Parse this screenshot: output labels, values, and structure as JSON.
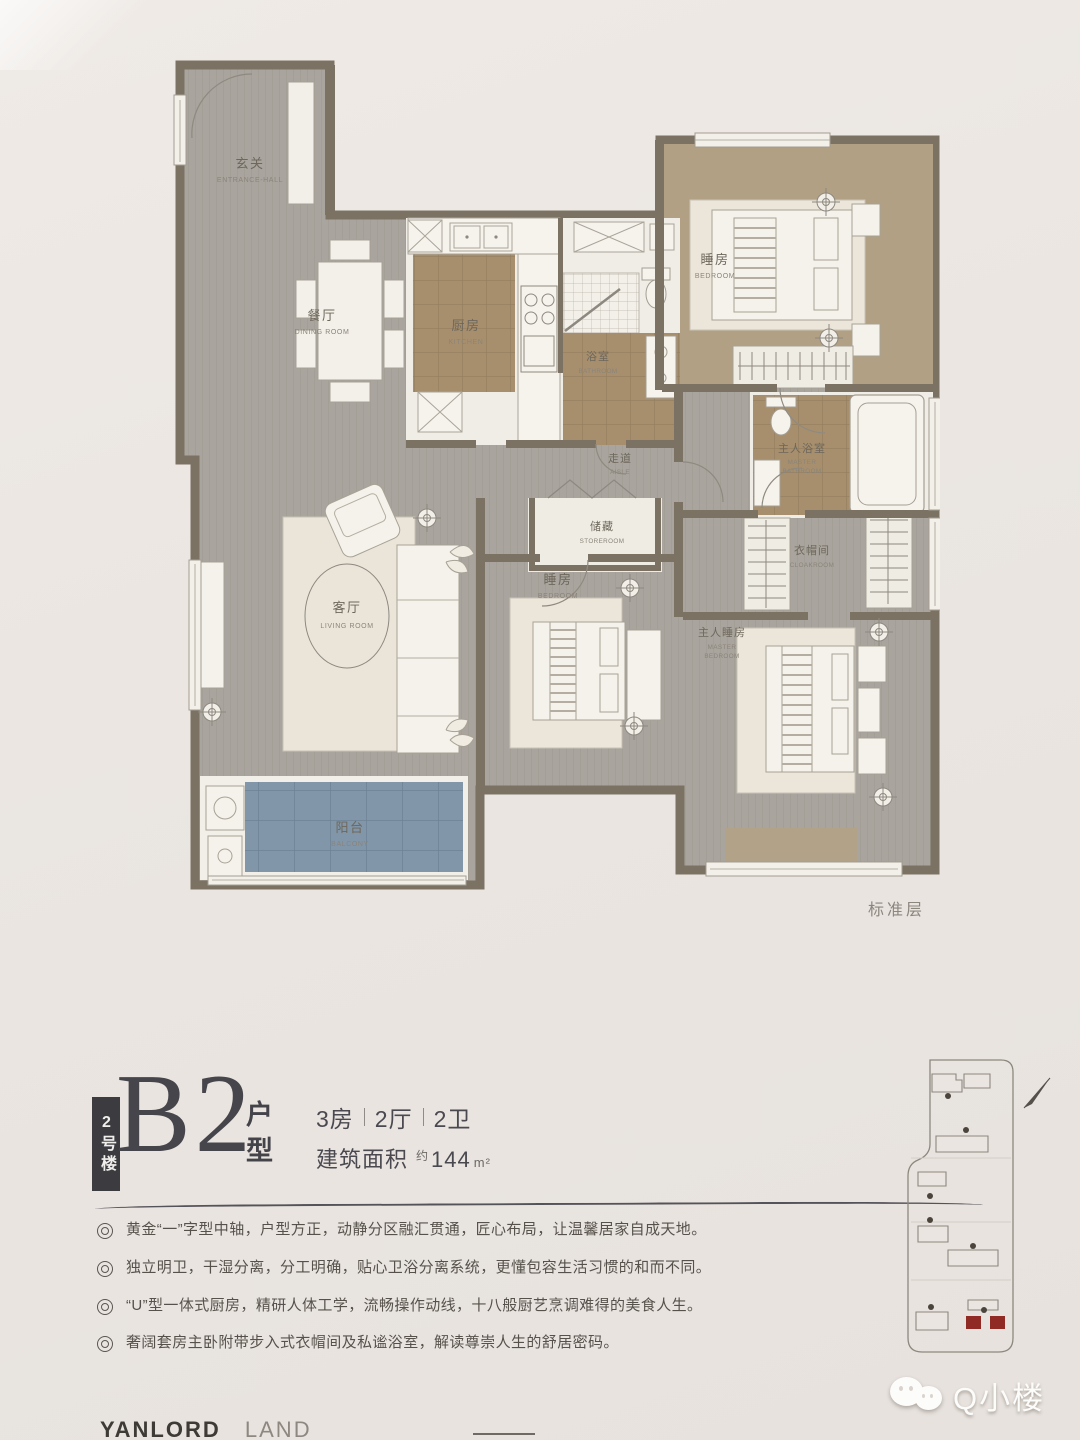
{
  "plan": {
    "floor_note": "标准层",
    "rooms": {
      "entrance": {
        "zh": "玄关",
        "en": "ENTRANCE-HALL"
      },
      "dining": {
        "zh": "餐厅",
        "en": "DINING ROOM"
      },
      "kitchen": {
        "zh": "厨房",
        "en": "KITCHEN"
      },
      "bathroom": {
        "zh": "浴室",
        "en": "BATHROOM"
      },
      "bedroom_top": {
        "zh": "睡房",
        "en": "BEDROOM"
      },
      "master_bathroom": {
        "zh": "主人浴室",
        "en1": "MASTER",
        "en2": "BATHROOM"
      },
      "aisle": {
        "zh": "走道",
        "en": "AISLE"
      },
      "storeroom": {
        "zh": "储藏",
        "en": "STOREROOM"
      },
      "bedroom_mid": {
        "zh": "睡房",
        "en": "BEDROOM"
      },
      "cloakroom": {
        "zh": "衣帽间",
        "en": "CLOAKROOM"
      },
      "living": {
        "zh": "客厅",
        "en": "LIVING ROOM"
      },
      "master_bedroom": {
        "zh": "主人睡房",
        "en1": "MASTER",
        "en2": "BEDROOM"
      },
      "balcony": {
        "zh": "阳台",
        "en": "BALCONY"
      }
    }
  },
  "title": {
    "building_badge": "2号楼",
    "code": "B2",
    "suffix_line1": "户",
    "suffix_line2": "型",
    "spec_parts": [
      "3房",
      "2厅",
      "2卫"
    ],
    "area_label": "建筑面积",
    "area_approx": "约",
    "area_value": "144",
    "area_unit": "m²"
  },
  "features": [
    "黄金“一”字型中轴，户型方正，动静分区融汇贯通，匠心布局，让温馨居家自成天地。",
    "独立明卫，干湿分离，分工明确，贴心卫浴分离系统，更懂包容生活习惯的和而不同。",
    "“U”型一体式厨房，精研人体工学，流畅操作动线，十八般厨艺烹调难得的美食人生。",
    "奢阔套房主卧附带步入式衣帽间及私谧浴室，解读尊崇人生的舒居密码。"
  ],
  "footer": {
    "brand_primary": "YANLORD",
    "brand_secondary": "LAND"
  },
  "watermark": {
    "label": "Q小楼"
  },
  "colors": {
    "wall": "#7b7264",
    "floor_gray": "#a9a49d",
    "tile_brown": "#a78f6e",
    "tile_blue": "#8296a9",
    "floor_tan": "#b1a084",
    "paper": "#ebe6e2",
    "accent_red": "#8f2b24",
    "ink": "#45444a"
  }
}
